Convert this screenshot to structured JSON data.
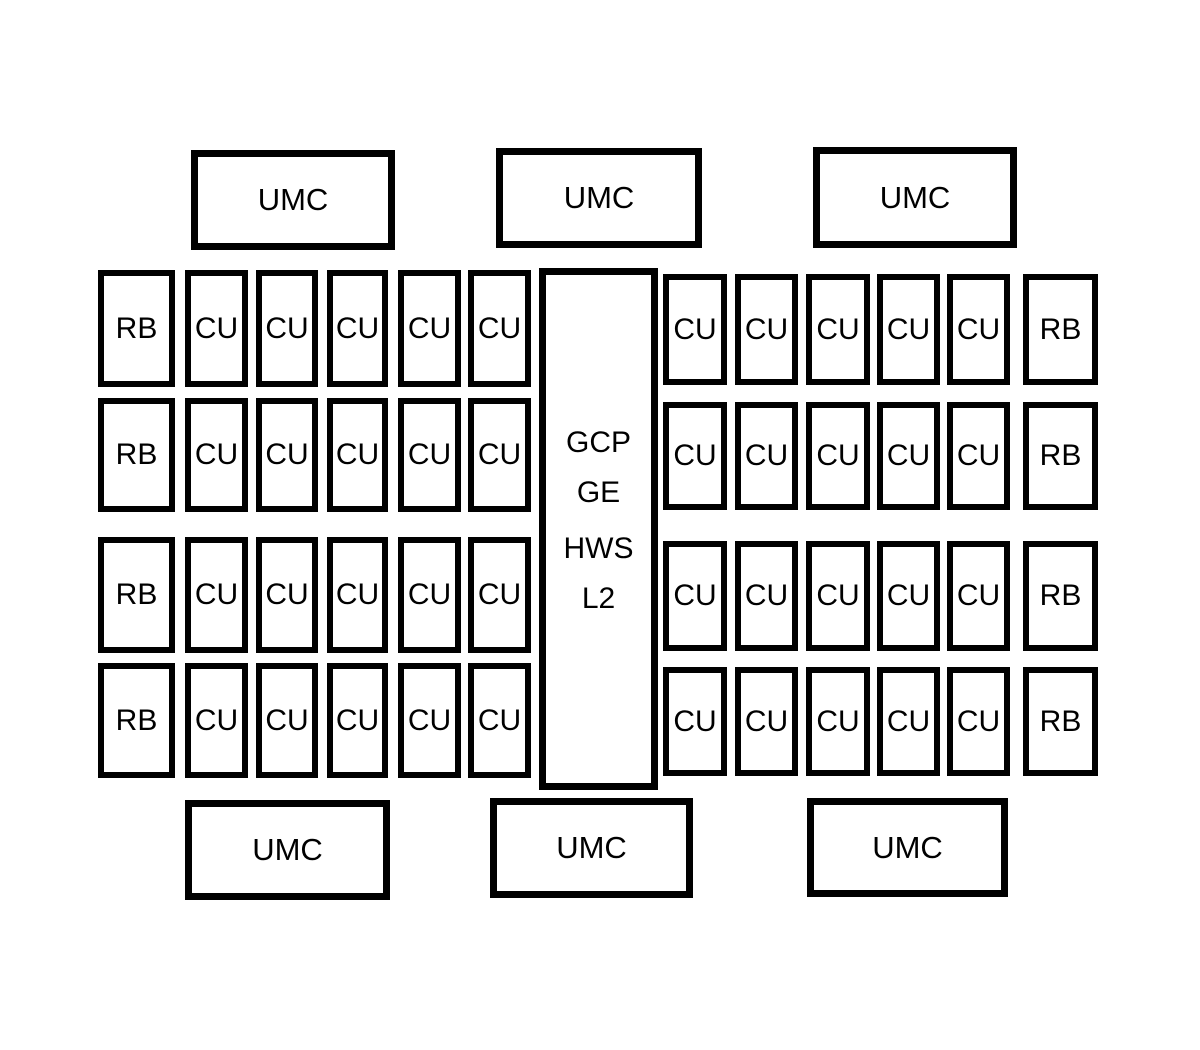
{
  "colors": {
    "line": "#000000",
    "bg": "#ffffff",
    "ink": "#000000"
  },
  "blocks": {
    "top_umc_row": [
      "UMC",
      "UMC",
      "UMC"
    ],
    "bottom_umc_row": [
      "UMC",
      "UMC",
      "UMC"
    ],
    "center_block": {
      "lines": [
        "GCP",
        "GE",
        "HWS",
        "L2"
      ]
    },
    "shader_rows": [
      {
        "left": [
          "RB",
          "CU",
          "CU",
          "CU",
          "CU",
          "CU"
        ],
        "right": [
          "CU",
          "CU",
          "CU",
          "CU",
          "CU",
          "RB"
        ]
      },
      {
        "left": [
          "RB",
          "CU",
          "CU",
          "CU",
          "CU",
          "CU"
        ],
        "right": [
          "CU",
          "CU",
          "CU",
          "CU",
          "CU",
          "RB"
        ]
      },
      {
        "left": [
          "RB",
          "CU",
          "CU",
          "CU",
          "CU",
          "CU"
        ],
        "right": [
          "CU",
          "CU",
          "CU",
          "CU",
          "CU",
          "RB"
        ]
      },
      {
        "left": [
          "RB",
          "CU",
          "CU",
          "CU",
          "CU",
          "CU"
        ],
        "right": [
          "CU",
          "CU",
          "CU",
          "CU",
          "CU",
          "RB"
        ]
      }
    ]
  }
}
